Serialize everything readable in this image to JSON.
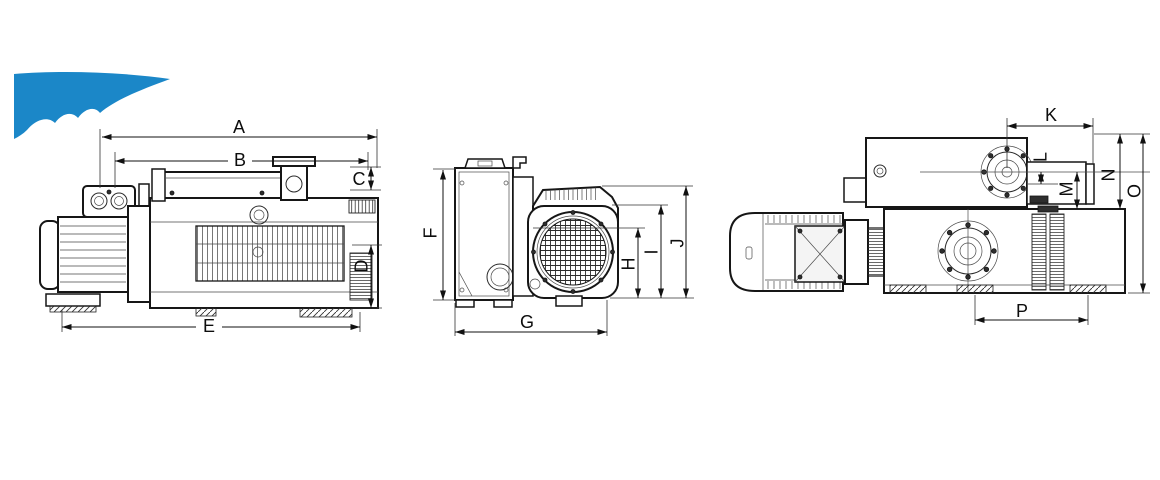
{
  "page": {
    "background": "#ffffff"
  },
  "logo": {
    "name": "blue-swoosh-logo-fragment",
    "color": "#1b87c8"
  },
  "drawing": {
    "type": "technical-dimension-diagram",
    "subject": "vacuum pump with motor, three orthographic views",
    "line_color": "#161616",
    "views": [
      {
        "id": "side-view",
        "dimension_labels": [
          "A",
          "B",
          "C",
          "D",
          "E"
        ]
      },
      {
        "id": "end-view",
        "dimension_labels": [
          "F",
          "G",
          "H",
          "I",
          "J"
        ]
      },
      {
        "id": "plan-view",
        "dimension_labels": [
          "K",
          "L",
          "M",
          "N",
          "O",
          "P"
        ]
      }
    ]
  },
  "dims": {
    "A": "A",
    "B": "B",
    "C": "C",
    "D": "D",
    "E": "E",
    "F": "F",
    "G": "G",
    "H": "H",
    "I": "I",
    "J": "J",
    "K": "K",
    "L": "L",
    "M": "M",
    "N": "N",
    "O": "O",
    "P": "P"
  }
}
